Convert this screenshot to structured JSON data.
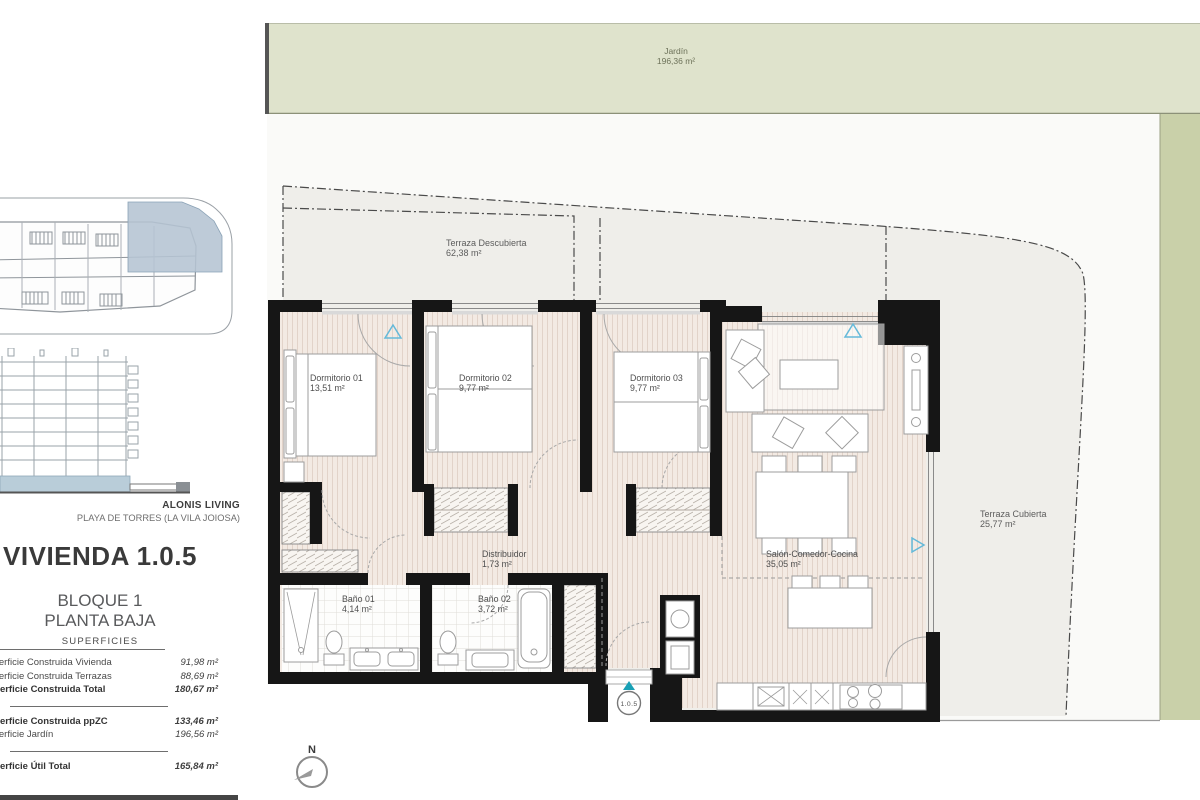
{
  "sidebar": {
    "brand": "ALONIS LIVING",
    "location": "PLAYA DE TORRES (LA VILA JOIOSA)",
    "title": "VIVIENDA 1.0.5",
    "block": "BLOQUE 1",
    "floor": "PLANTA BAJA",
    "surfaces_heading": "SUPERFICIES",
    "surfaces": [
      {
        "label": "Superficie Construida Vivienda",
        "value": "91,98 m²"
      },
      {
        "label": "Superficie Construida Terrazas",
        "value": "88,69 m²"
      },
      {
        "label": "Superficie Construida Total",
        "value": "180,67 m²"
      },
      {
        "label": "Superficie Construida ppZC",
        "value": "133,46 m²"
      },
      {
        "label": "Superficie Jardín",
        "value": "196,56 m²"
      },
      {
        "label": "Superficie Útil Total",
        "value": "165,84 m²"
      }
    ]
  },
  "plan": {
    "unit_marker": "1.0.5",
    "compass": "N",
    "rooms": [
      {
        "name": "Jardín",
        "area": "196,36 m²"
      },
      {
        "name": "Terraza Descubierta",
        "area": "62,38 m²"
      },
      {
        "name": "Terraza Cubierta",
        "area": "25,77 m²"
      },
      {
        "name": "Dormitorio 01",
        "area": "13,51 m²"
      },
      {
        "name": "Dormitorio 02",
        "area": "9,77 m²"
      },
      {
        "name": "Dormitorio 03",
        "area": "9,77 m²"
      },
      {
        "name": "Salón-Comedor-Cocina",
        "area": "35,05 m²"
      },
      {
        "name": "Distribuidor",
        "area": "1,73 m²"
      },
      {
        "name": "Baño 01",
        "area": "4,14 m²"
      },
      {
        "name": "Baño 02",
        "area": "3,72 m²"
      }
    ]
  },
  "colors": {
    "garden_light": "#dfe3cc",
    "garden_dark": "#c9d0a9",
    "terrace_gray": "#efeeea",
    "floor_pink": "#f3eae3",
    "wall_black": "#161616",
    "highlight_blue": "#b5c4d3",
    "elevation_blue": "#b9cdd9",
    "accent_teal": "#18a0b5"
  }
}
